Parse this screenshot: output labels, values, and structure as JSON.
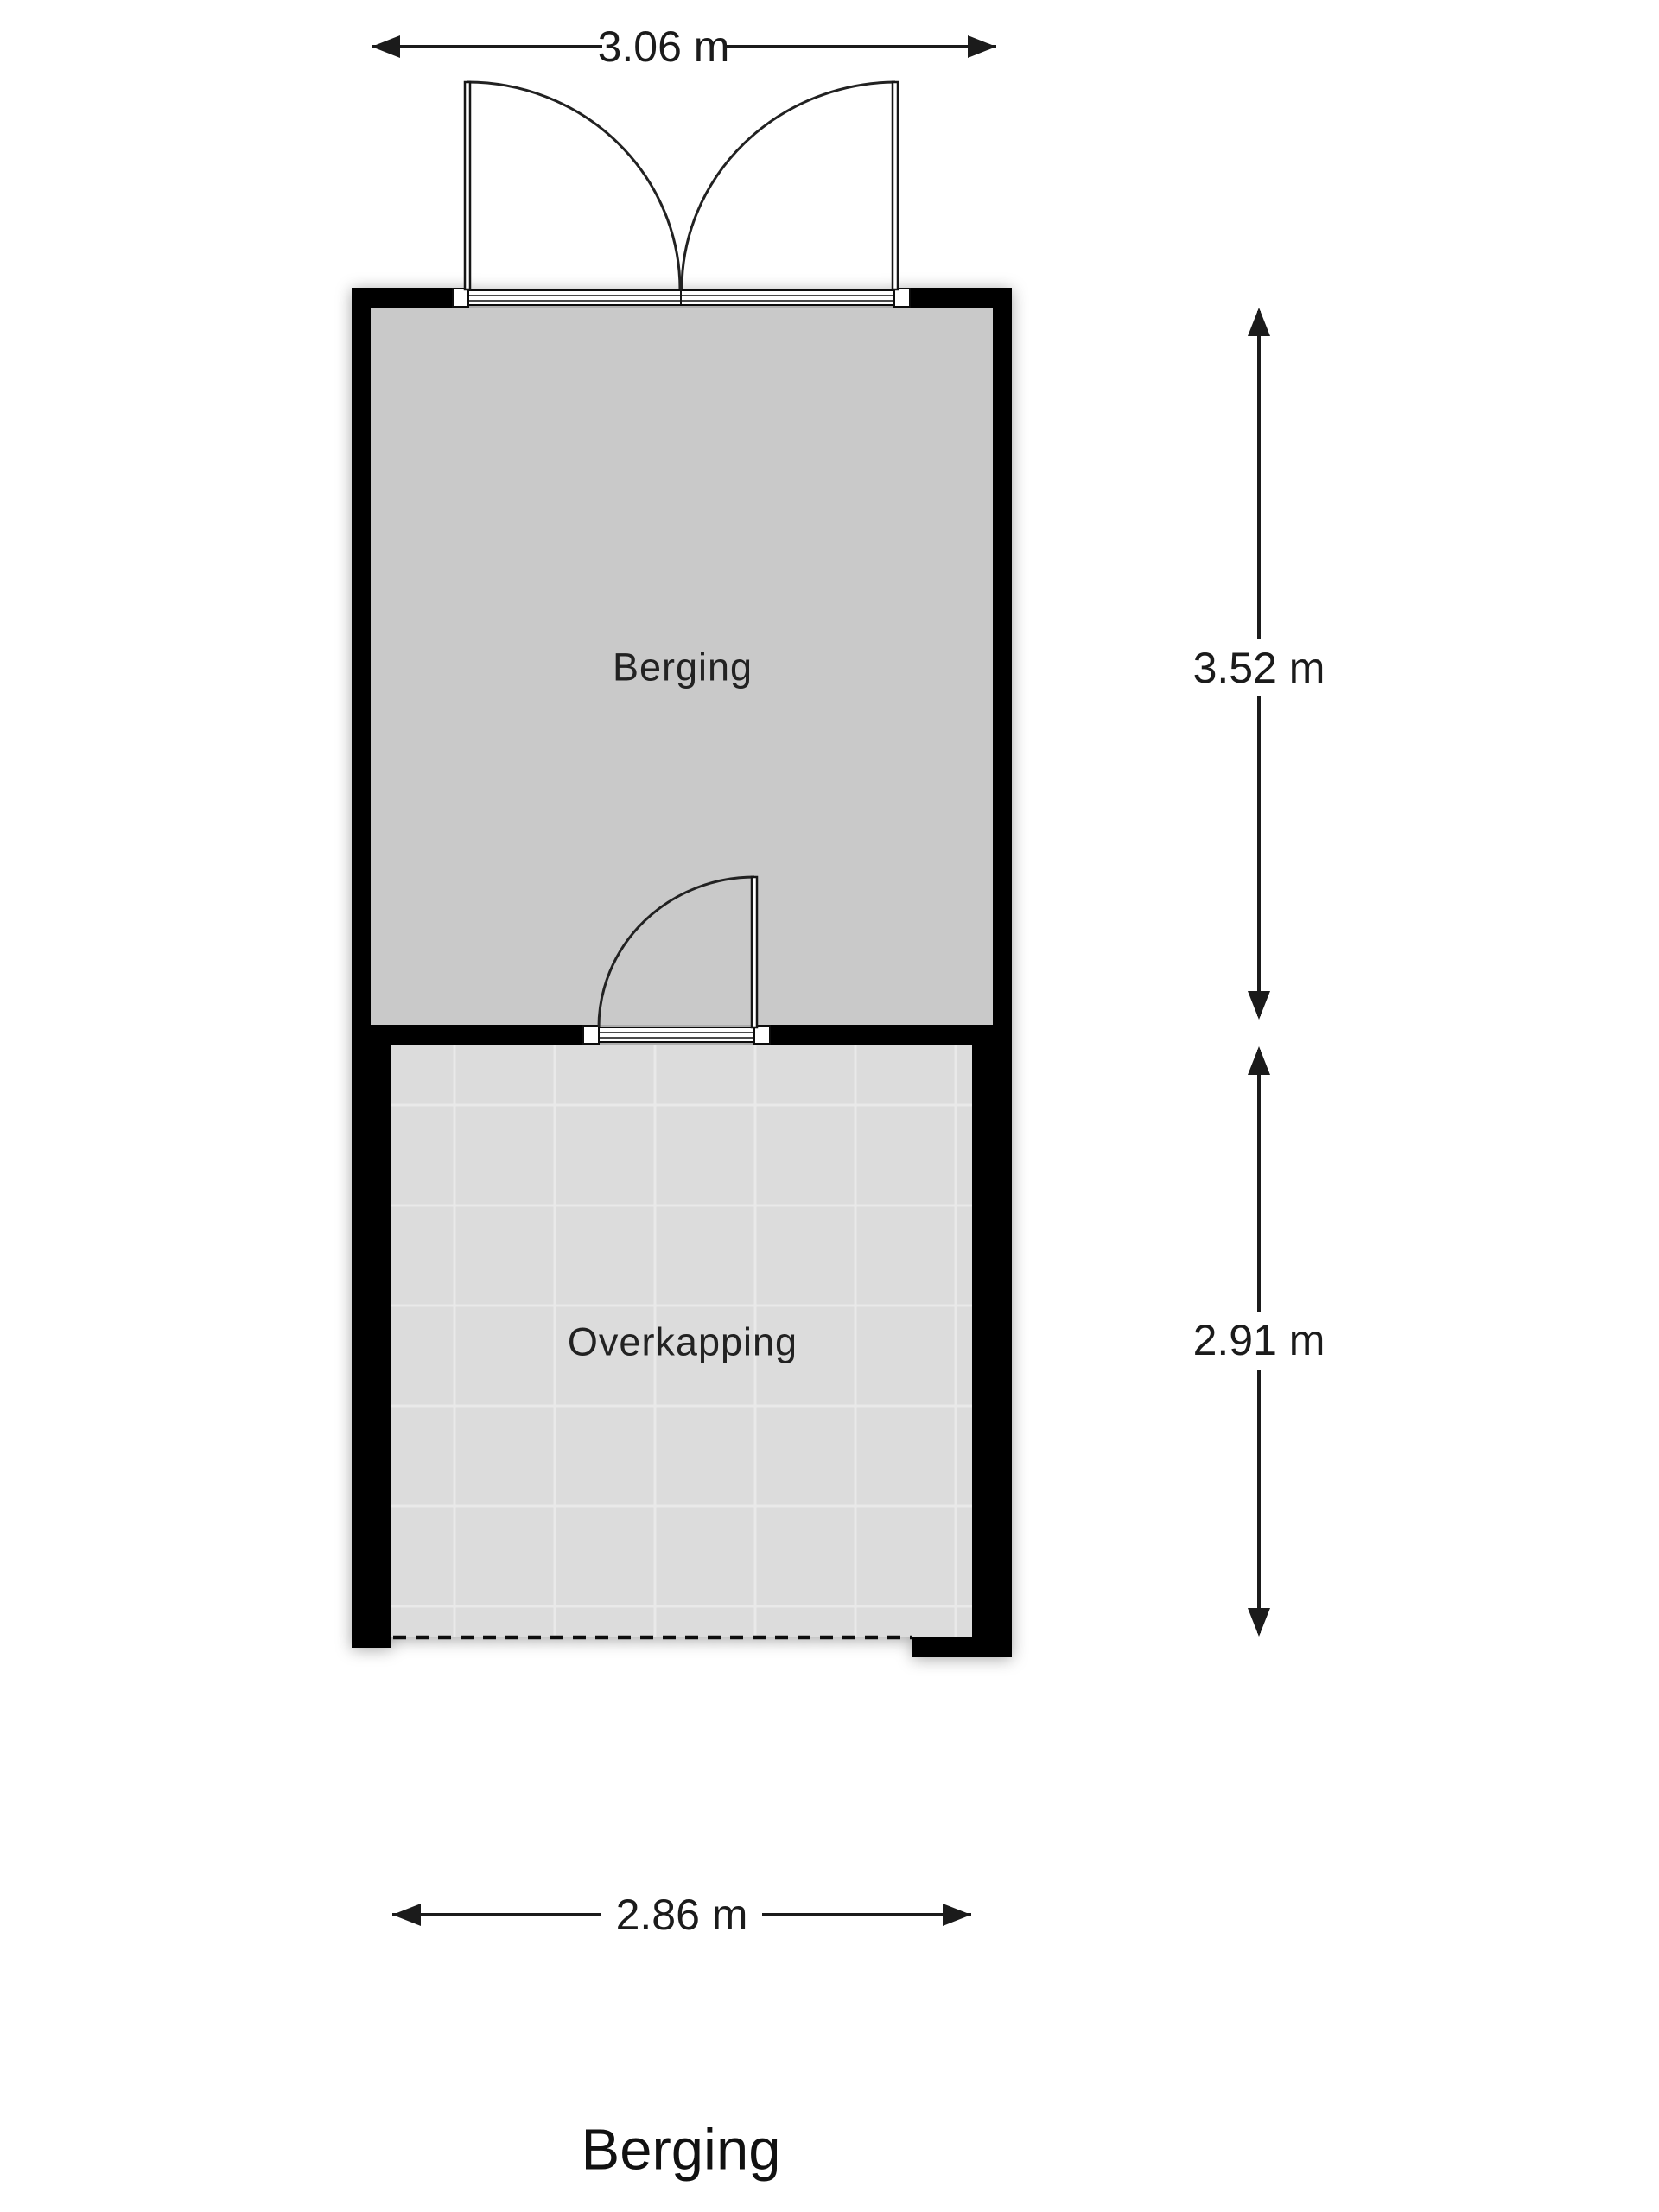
{
  "page_title": "Berging",
  "plan": {
    "title": "Berging",
    "rooms": [
      {
        "label": "Berging"
      },
      {
        "label": "Overkapping"
      }
    ],
    "dimensions": {
      "top": "3.06 m",
      "side_upper": "3.52 m",
      "side_lower": "2.91 m",
      "bottom": "2.86 m"
    }
  },
  "colors": {
    "wall": "#000000",
    "floor_berging": "#c9c9c9",
    "floor_overkapping": "#dcdcdc",
    "tile_line": "#e9e9e9",
    "line": "#1b1b1b",
    "background": "#ffffff"
  }
}
